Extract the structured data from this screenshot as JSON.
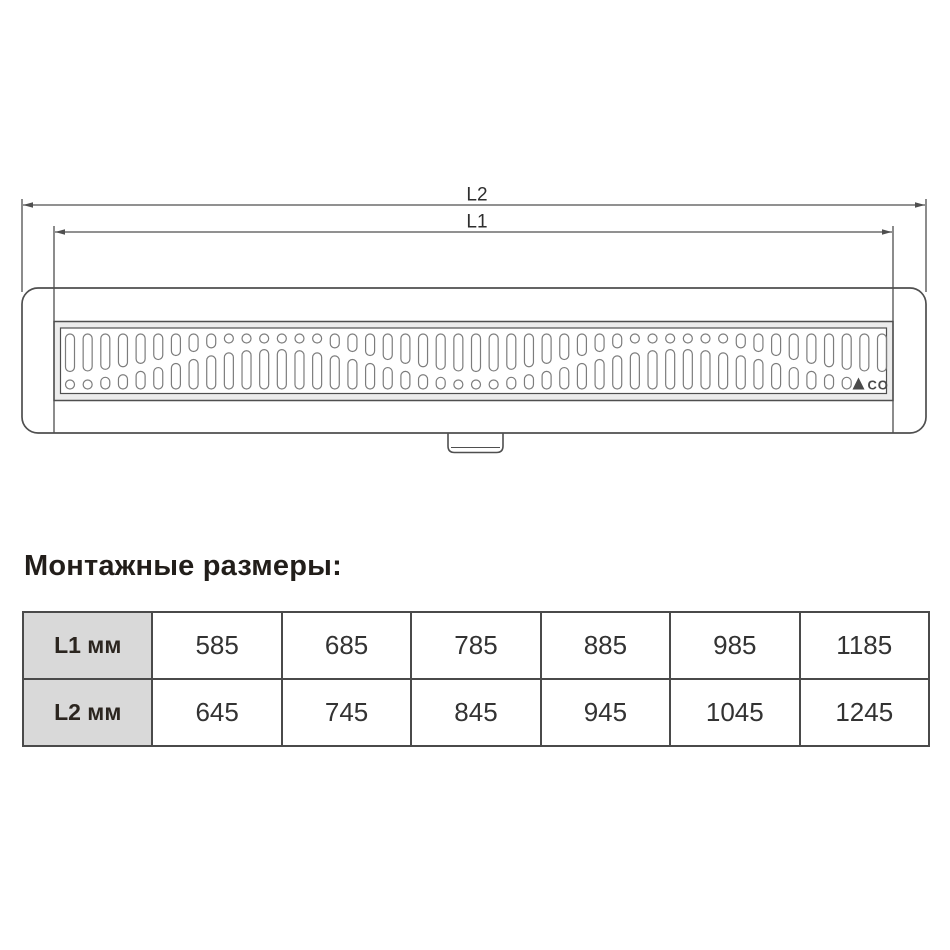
{
  "drawing": {
    "dim_labels": {
      "outer": "L2",
      "inner": "L1"
    },
    "brand": "ACO"
  },
  "section_title": "Монтажные размеры:",
  "table": {
    "rows": [
      {
        "label": "L1 мм",
        "values": [
          "585",
          "685",
          "785",
          "885",
          "985",
          "1185"
        ]
      },
      {
        "label": "L2 мм",
        "values": [
          "645",
          "745",
          "845",
          "945",
          "1045",
          "1245"
        ]
      }
    ]
  },
  "chart_data": {
    "type": "table",
    "title": "Монтажные размеры:",
    "row_headers": [
      "L1 мм",
      "L2 мм"
    ],
    "rows": [
      [
        585,
        685,
        785,
        885,
        985,
        1185
      ],
      [
        645,
        745,
        845,
        945,
        1045,
        1245
      ]
    ]
  },
  "colors": {
    "line": "#4f4f4f",
    "slot_stroke": "#7c7c7c",
    "frame_band": "#ececec",
    "dim_text": "#2e2e2e",
    "logo": "#4a4a4a",
    "table_border": "#4a4a4a",
    "header_bg": "#d9d9d9"
  }
}
